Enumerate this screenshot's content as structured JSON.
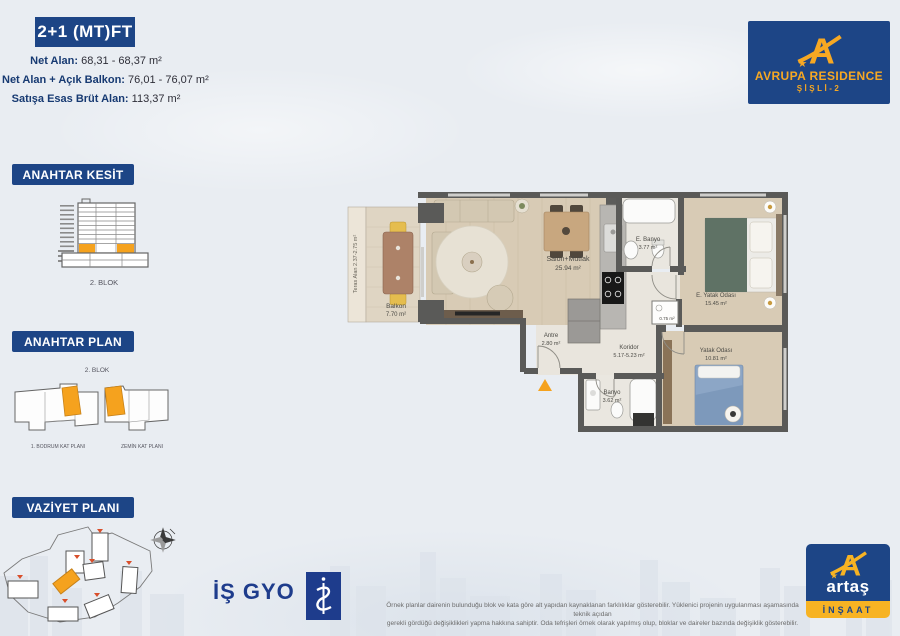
{
  "colors": {
    "accent_blue": "#1d4586",
    "accent_orange": "#f5a21e",
    "logo_yellow": "#f7a823"
  },
  "title": {
    "unit": "2+1 (MT)FT"
  },
  "areas": {
    "net": {
      "label": "Net Alan:",
      "value": "68,31 - 68,37 m²"
    },
    "balkon": {
      "label": "Net Alan + Açık Balkon:",
      "value": "76,01 - 76,07 m²"
    },
    "brut": {
      "label": "Satışa Esas Brüt Alan:",
      "value": "113,37 m²"
    }
  },
  "logo": {
    "mark": "A",
    "star": "★",
    "brand": "AVRUPA RESIDENCE",
    "sub": "ŞİŞLİ-2"
  },
  "sections": {
    "kesit": {
      "title": "ANAHTAR KESİT",
      "caption": "2. BLOK"
    },
    "plan": {
      "title": "ANAHTAR PLAN",
      "caption": "2. BLOK",
      "left_label": "1. BODRUM KAT PLANI",
      "right_label": "ZEMİN KAT PLANI"
    },
    "vaziyet": {
      "title": "VAZİYET PLANI"
    }
  },
  "floorplan": {
    "terrace_note": "Teras Alan 2.37-2.75 m²",
    "rooms": {
      "balkon": {
        "name": "Balkon",
        "area": "7.70 m²"
      },
      "salon": {
        "name": "Salon+Mutfak",
        "area": "25.94 m²"
      },
      "antre": {
        "name": "Antre",
        "area": "2.80 m²"
      },
      "koridor": {
        "name": "Koridor",
        "area": "5.17-5.23 m²"
      },
      "ebanyo": {
        "name": "E. Banyo",
        "area": "3.77 m²"
      },
      "eyatak": {
        "name": "E. Yatak Odası",
        "area": "15.45 m²"
      },
      "banyo": {
        "name": "Banyo",
        "area": "3.62 m²"
      },
      "yatak": {
        "name": "Yatak Odası",
        "area": "10.81 m²"
      },
      "shaft": {
        "area": "0.75 m²"
      }
    }
  },
  "footer": {
    "isgyo": "İŞ GYO",
    "artas": {
      "mark": "A",
      "star": "★",
      "name": "artaş",
      "sub": "İNŞAAT"
    },
    "disclaimer1": "Örnek planlar dairenin bulunduğu blok ve kata göre alt yapıdan kaynaklanan farklılıklar gösterebilir. Yüklenici projenin uygulanması aşamasında teknik açıdan",
    "disclaimer2": "gerekli gördüğü değişiklikleri yapma hakkına sahiptir. Oda tefrişleri örnek olarak yapılmış olup, bloklar ve daireler bazında değişiklik gösterebilir."
  }
}
